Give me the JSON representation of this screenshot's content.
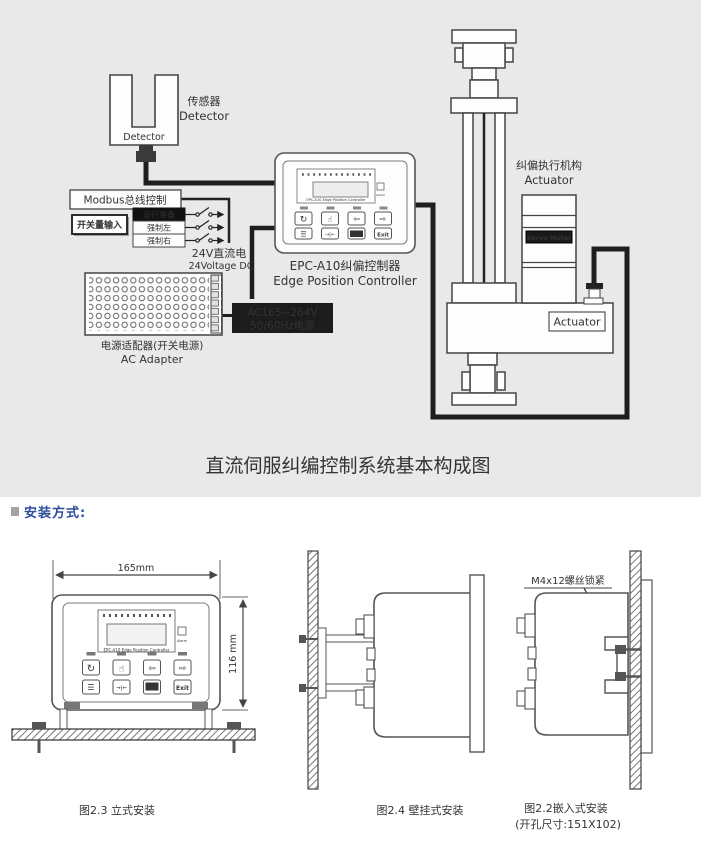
{
  "colors": {
    "diagram_bg": "#e9e9e9",
    "page_bg": "#ffffff",
    "line": "#444444",
    "cable": "#1e1e1e",
    "black_box": "#1c1c1c",
    "header_blue": "#2b4c9c",
    "header_square": "#a3a3a3"
  },
  "system": {
    "sensor": {
      "cn": "传感器",
      "en": "Detector",
      "device_label": "Detector"
    },
    "modbus_label": "Modbus总线控制",
    "switch_input": {
      "title": "开关量输入",
      "rows": [
        "运行准备",
        "强制左",
        "强制右"
      ]
    },
    "dc24": {
      "cn": "24V直流电",
      "en": "24Voltage DC"
    },
    "controller": {
      "cn": "EPC-A10纠偏控制器",
      "en": "Edge Position Controller",
      "panel_title": "EPC-A10  Edge Position Controller",
      "alarm": "Alarm"
    },
    "ac_power": {
      "line1": "AC165~264V",
      "line2": "50/60Hz电源"
    },
    "adapter": {
      "cn": "电源适配器(开关电源)",
      "en": "AC Adapter"
    },
    "actuator": {
      "cn": "纠偏执行机构",
      "en": "Actuator",
      "servo": "Servo Motor",
      "tag": "Actuator"
    },
    "caption": "直流伺服纠编控制系统基本构成图"
  },
  "panel_icons": {
    "auto": "↻",
    "manual": "☝",
    "left": "⇦",
    "right": "⇨",
    "menu": "☰",
    "center": "→|←",
    "setup": "Setup",
    "exit": "Exit"
  },
  "install": {
    "header": "安装方式:",
    "fig_vertical": {
      "dim_width": "165mm",
      "dim_height": "116 mm",
      "caption": "图2.3 立式安装"
    },
    "fig_wall": {
      "caption": "图2.4 壁挂式安装"
    },
    "fig_embedded": {
      "caption": "图2.2嵌入式安装",
      "hole_size": "(开孔尺寸:151X102)",
      "screw_label": "M4x12螺丝锁紧"
    }
  }
}
